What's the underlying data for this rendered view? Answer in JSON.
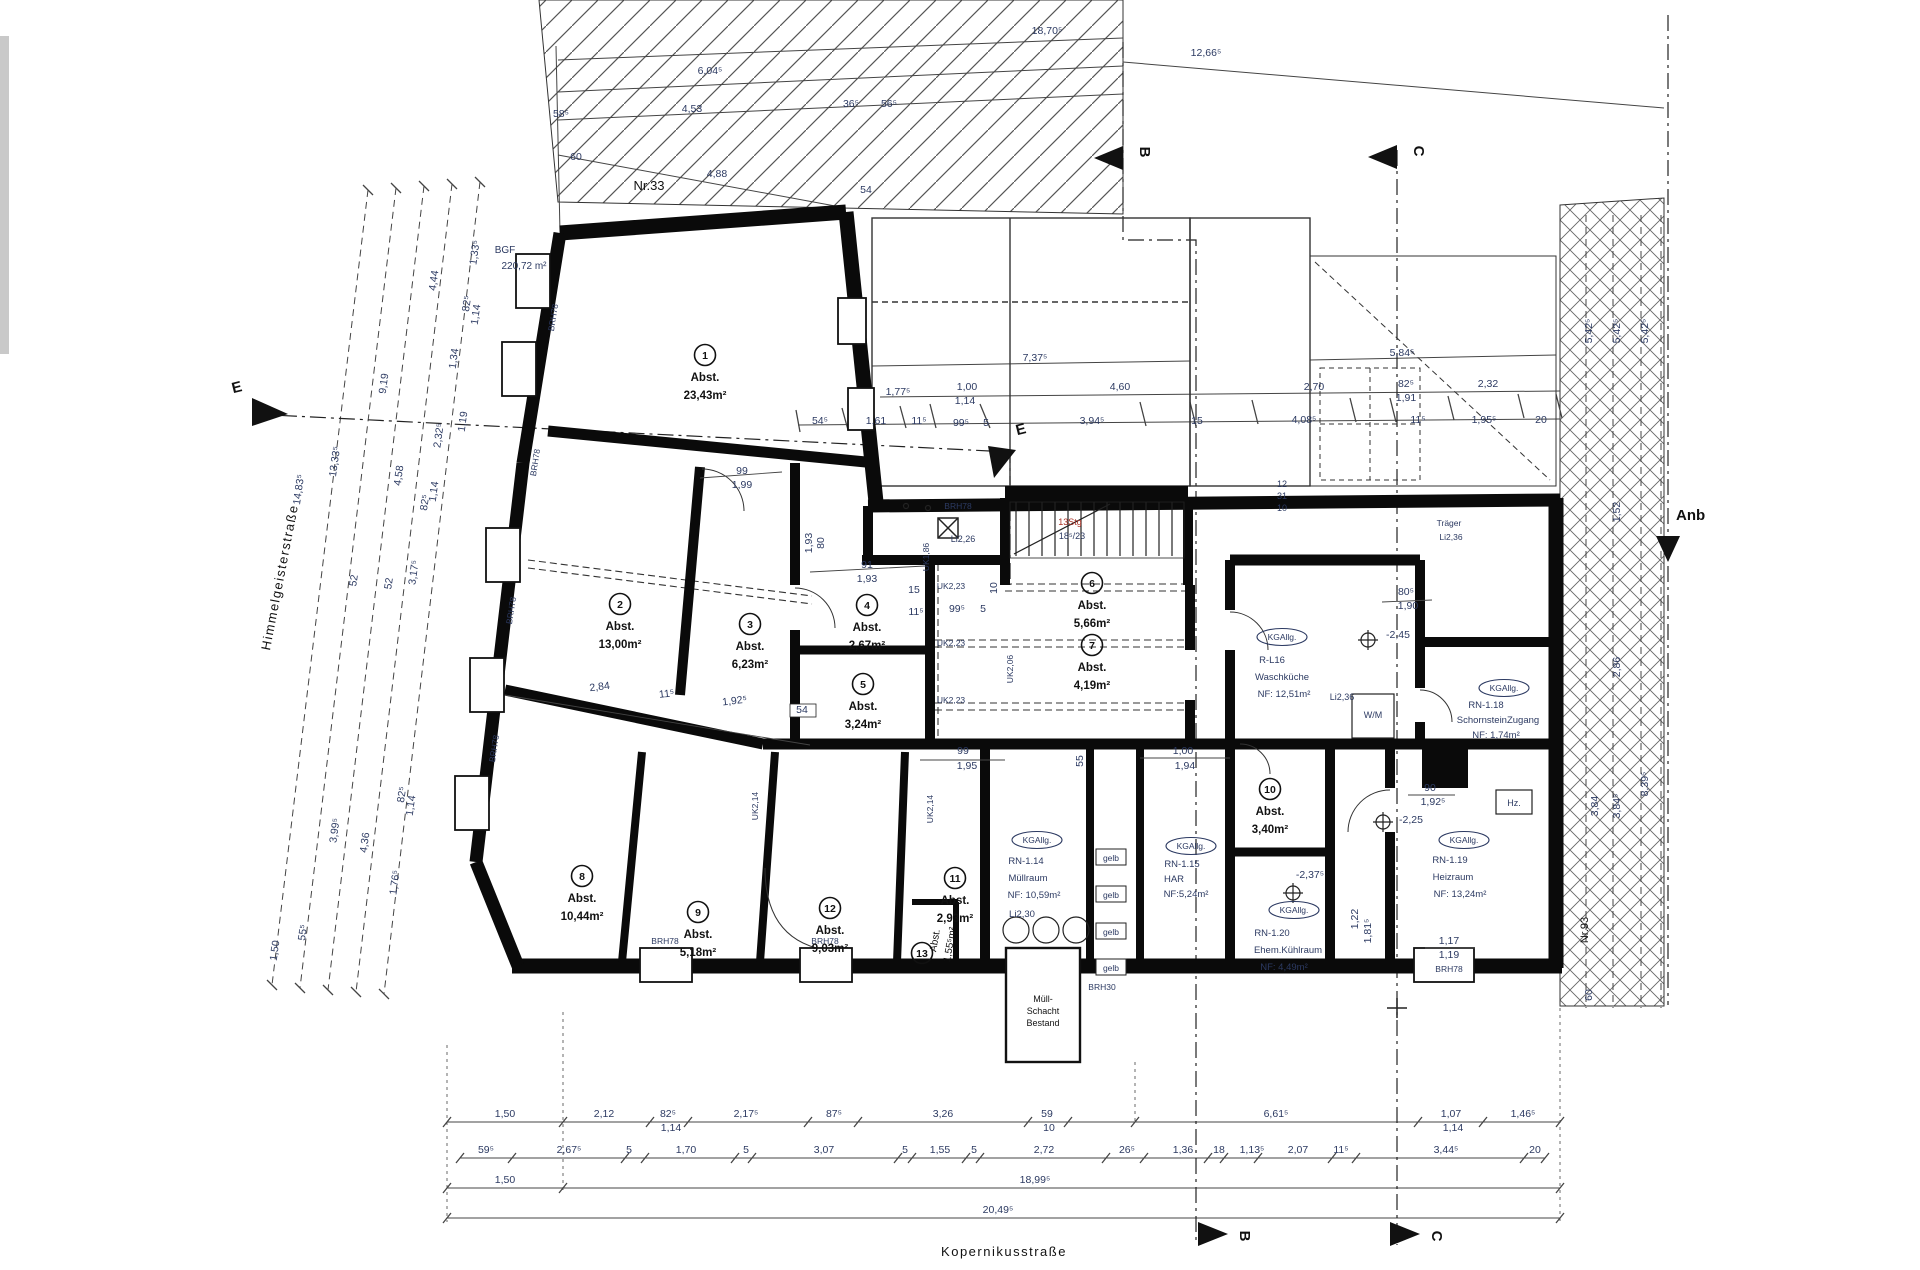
{
  "colors": {
    "dim": "#2c3a62",
    "note": "#2c3a62",
    "label": "#111111",
    "red": "#a93226",
    "wall": "#000000",
    "hatch": "#555555",
    "scrollbar": "#c9c9c9"
  },
  "streets": {
    "left": "Himmelgeisterstraße",
    "bottom": "Kopernikusstraße"
  },
  "site": {
    "neighbor_top": "Nr.33",
    "neighbor_right": "Nr.93",
    "annex_label": "Anb",
    "bgf_line1": "BGF",
    "bgf_line2": "220,72 m²"
  },
  "markers": [
    {
      "label": "B",
      "x": 1140,
      "y": 152,
      "rot": 90,
      "tri": "1123,146 1123,170 1094,158"
    },
    {
      "label": "C",
      "x": 1414,
      "y": 151,
      "rot": 90,
      "tri": "1397,145 1397,169 1368,157"
    },
    {
      "label": "E",
      "x": 238,
      "y": 392,
      "rot": -14,
      "tri": "252,398 252,426 288,414"
    },
    {
      "label": "E",
      "x": 1022,
      "y": 434,
      "rot": -14,
      "tri": "988,446 1016,450 994,478"
    },
    {
      "label": "B",
      "x": 1240,
      "y": 1236,
      "rot": 90,
      "tri": "1198,1222 1198,1246 1228,1234"
    },
    {
      "label": "C",
      "x": 1432,
      "y": 1236,
      "rot": 90,
      "tri": "1390,1222 1390,1246 1420,1234"
    }
  ],
  "annex_marker_tri": "1656,536 1680,536 1668,562",
  "rooms": [
    {
      "n": "1",
      "x": 705,
      "y": 355,
      "a1": "Abst.",
      "a2": "23,43m²"
    },
    {
      "n": "2",
      "x": 620,
      "y": 604,
      "a1": "Abst.",
      "a2": "13,00m²"
    },
    {
      "n": "3",
      "x": 750,
      "y": 624,
      "a1": "Abst.",
      "a2": "6,23m²"
    },
    {
      "n": "4",
      "x": 867,
      "y": 605,
      "a1": "Abst.",
      "a2": "2,67m²"
    },
    {
      "n": "5",
      "x": 863,
      "y": 684,
      "a1": "Abst.",
      "a2": "3,24m²"
    },
    {
      "n": "6",
      "x": 1092,
      "y": 583,
      "a1": "Abst.",
      "a2": "5,66m²"
    },
    {
      "n": "7",
      "x": 1092,
      "y": 645,
      "a1": "Abst.",
      "a2": "4,19m²"
    },
    {
      "n": "8",
      "x": 582,
      "y": 876,
      "a1": "Abst.",
      "a2": "10,44m²"
    },
    {
      "n": "9",
      "x": 698,
      "y": 912,
      "a1": "Abst.",
      "a2": "5,18m²"
    },
    {
      "n": "10",
      "x": 1270,
      "y": 789,
      "a1": "Abst.",
      "a2": "3,40m²"
    },
    {
      "n": "11",
      "x": 955,
      "y": 878,
      "a1": "Abst.",
      "a2": "2,93m²"
    },
    {
      "n": "12",
      "x": 830,
      "y": 908,
      "a1": "Abst.",
      "a2": "9,03m²"
    },
    {
      "n": "13",
      "x": 922,
      "y": 953,
      "a1": "",
      "a2": ""
    }
  ],
  "spaces": [
    {
      "oval": "KGAllg.",
      "ox": 1282,
      "oy": 637,
      "lines": [
        {
          "t": "R-L16",
          "x": 1272,
          "y": 663
        },
        {
          "t": "Waschküche",
          "x": 1282,
          "y": 680
        },
        {
          "t": "NF: 12,51m²",
          "x": 1284,
          "y": 697
        }
      ]
    },
    {
      "oval": "KGAllg.",
      "ox": 1504,
      "oy": 688,
      "lines": [
        {
          "t": "RN-1.18",
          "x": 1486,
          "y": 708
        },
        {
          "t": "SchornsteinZugang",
          "x": 1498,
          "y": 723
        },
        {
          "t": "NF: 1,74m²",
          "x": 1496,
          "y": 738
        }
      ]
    },
    {
      "oval": "KGAllg.",
      "ox": 1464,
      "oy": 840,
      "lines": [
        {
          "t": "RN-1.19",
          "x": 1450,
          "y": 863
        },
        {
          "t": "Heizraum",
          "x": 1453,
          "y": 880
        },
        {
          "t": "NF: 13,24m²",
          "x": 1460,
          "y": 897
        }
      ]
    },
    {
      "oval": "KGAllg.",
      "ox": 1294,
      "oy": 910,
      "lines": [
        {
          "t": "RN-1.20",
          "x": 1272,
          "y": 936
        },
        {
          "t": "Ehem.Kühlraum",
          "x": 1288,
          "y": 953
        },
        {
          "t": "NF: 4,49m²",
          "x": 1284,
          "y": 970
        }
      ]
    },
    {
      "oval": "KGAllg.",
      "ox": 1037,
      "oy": 840,
      "lines": [
        {
          "t": "RN-1.14",
          "x": 1026,
          "y": 864
        },
        {
          "t": "Müllraum",
          "x": 1028,
          "y": 881
        },
        {
          "t": "NF: 10,59m²",
          "x": 1034,
          "y": 898
        },
        {
          "t": "Li2,30",
          "x": 1022,
          "y": 917
        }
      ]
    },
    {
      "oval": "KGAllg.",
      "ox": 1191,
      "oy": 846,
      "lines": [
        {
          "t": "RN-1.15",
          "x": 1182,
          "y": 867
        },
        {
          "t": "HAR",
          "x": 1174,
          "y": 882
        },
        {
          "t": "NF:5,24m²",
          "x": 1186,
          "y": 897
        }
      ]
    }
  ],
  "notes": [
    {
      "t": "Nr.33",
      "x": 649,
      "y": 190,
      "s": 13,
      "c": "#111111"
    },
    {
      "t": "Nr.93",
      "x": 1588,
      "y": 930,
      "r": -90,
      "s": 11,
      "c": "#111111"
    },
    {
      "t": "BGF",
      "x": 505,
      "y": 253,
      "s": 10
    },
    {
      "t": "220,72 m²",
      "x": 524,
      "y": 269,
      "s": 10
    },
    {
      "t": "Träger",
      "x": 1449,
      "y": 526,
      "s": 8.5
    },
    {
      "t": "Li2,36",
      "x": 1451,
      "y": 540,
      "s": 8.5
    },
    {
      "t": "Li2,36",
      "x": 1342,
      "y": 700,
      "s": 9
    },
    {
      "t": "BRH78",
      "x": 958,
      "y": 509,
      "s": 8.5
    },
    {
      "t": "Li2,26",
      "x": 963,
      "y": 542,
      "s": 9
    },
    {
      "t": "UK2,23",
      "x": 951,
      "y": 589,
      "s": 8.5
    },
    {
      "t": "UK2,23",
      "x": 951,
      "y": 646,
      "s": 8.5
    },
    {
      "t": "UK2,23",
      "x": 951,
      "y": 703,
      "s": 8.5
    },
    {
      "t": "UK1,86",
      "x": 929,
      "y": 557,
      "r": -90,
      "s": 8.5
    },
    {
      "t": "UK2,06",
      "x": 1013,
      "y": 669,
      "r": -90,
      "s": 8.5
    },
    {
      "t": "UK2,14",
      "x": 758,
      "y": 806,
      "r": -90,
      "s": 8.5
    },
    {
      "t": "UK2,14",
      "x": 933,
      "y": 809,
      "r": -90,
      "s": 8.5
    },
    {
      "t": "BRH78",
      "x": 556,
      "y": 318,
      "r": -81,
      "s": 8.5
    },
    {
      "t": "BRH78",
      "x": 538,
      "y": 463,
      "r": -81,
      "s": 8.5
    },
    {
      "t": "BRH78",
      "x": 514,
      "y": 611,
      "r": -81,
      "s": 8.5
    },
    {
      "t": "BRH78",
      "x": 497,
      "y": 749,
      "r": -81,
      "s": 8.5
    },
    {
      "t": "BRH78",
      "x": 665,
      "y": 944,
      "s": 8.5
    },
    {
      "t": "BRH78",
      "x": 825,
      "y": 944,
      "s": 8.5
    },
    {
      "t": "BRH78",
      "x": 1449,
      "y": 972,
      "s": 8.5
    },
    {
      "t": "13Stg",
      "x": 1070,
      "y": 525,
      "s": 9,
      "c": "#a93226"
    },
    {
      "t": "18⁵/23",
      "x": 1072,
      "y": 539,
      "s": 9
    },
    {
      "t": "W/M",
      "x": 1373,
      "y": 718,
      "s": 9
    },
    {
      "t": "Hz.",
      "x": 1514,
      "y": 806,
      "s": 9
    },
    {
      "t": "gelb",
      "x": 1111,
      "y": 861,
      "s": 8.5
    },
    {
      "t": "gelb",
      "x": 1111,
      "y": 898,
      "s": 8.5
    },
    {
      "t": "gelb",
      "x": 1111,
      "y": 935,
      "s": 8.5
    },
    {
      "t": "gelb",
      "x": 1111,
      "y": 971,
      "s": 8.5
    },
    {
      "t": "BRH30",
      "x": 1102,
      "y": 990,
      "s": 8.5
    },
    {
      "t": "Müll-",
      "x": 1043,
      "y": 1002,
      "s": 9,
      "c": "#111111"
    },
    {
      "t": "Schacht",
      "x": 1043,
      "y": 1014,
      "s": 9,
      "c": "#111111"
    },
    {
      "t": "Bestand",
      "x": 1043,
      "y": 1026,
      "s": 9,
      "c": "#111111"
    },
    {
      "t": "Abst.",
      "x": 938,
      "y": 941,
      "r": -80,
      "s": 10,
      "c": "#111111"
    },
    {
      "t": "1,55⁵m²",
      "x": 953,
      "y": 945,
      "r": -80,
      "s": 10,
      "c": "#111111"
    }
  ],
  "dims": [
    {
      "t": "18,70⁵",
      "x": 1047,
      "y": 34
    },
    {
      "t": "12,66⁵",
      "x": 1206,
      "y": 56
    },
    {
      "t": "6,04⁵",
      "x": 710,
      "y": 74
    },
    {
      "t": "4,53",
      "x": 692,
      "y": 112
    },
    {
      "t": "58⁵",
      "x": 561,
      "y": 117
    },
    {
      "t": "36⁵",
      "x": 851,
      "y": 107
    },
    {
      "t": "56⁵",
      "x": 889,
      "y": 107
    },
    {
      "t": "60",
      "x": 576,
      "y": 160
    },
    {
      "t": "4,88",
      "x": 717,
      "y": 177
    },
    {
      "t": "54",
      "x": 866,
      "y": 193
    },
    {
      "t": "7,37⁵",
      "x": 1035,
      "y": 361
    },
    {
      "t": "5,84⁵",
      "x": 1402,
      "y": 356
    },
    {
      "t": "1,77⁵",
      "x": 898,
      "y": 395
    },
    {
      "t": "1,00",
      "x": 967,
      "y": 390
    },
    {
      "t": "1,14",
      "x": 965,
      "y": 404
    },
    {
      "t": "4,60",
      "x": 1120,
      "y": 390
    },
    {
      "t": "2,70",
      "x": 1314,
      "y": 390
    },
    {
      "t": "82⁵",
      "x": 1406,
      "y": 387
    },
    {
      "t": "1,91",
      "x": 1406,
      "y": 401
    },
    {
      "t": "2,32",
      "x": 1488,
      "y": 387
    },
    {
      "t": "54⁵",
      "x": 820,
      "y": 424
    },
    {
      "t": "1,61",
      "x": 876,
      "y": 424
    },
    {
      "t": "11⁵",
      "x": 919,
      "y": 424
    },
    {
      "t": "99⁵",
      "x": 961,
      "y": 426
    },
    {
      "t": "5",
      "x": 986,
      "y": 426
    },
    {
      "t": "3,94⁵",
      "x": 1092,
      "y": 424
    },
    {
      "t": "15",
      "x": 1197,
      "y": 424
    },
    {
      "t": "4,08⁵",
      "x": 1304,
      "y": 423
    },
    {
      "t": "11⁵",
      "x": 1418,
      "y": 423
    },
    {
      "t": "1,95⁵",
      "x": 1484,
      "y": 423
    },
    {
      "t": "20",
      "x": 1541,
      "y": 423
    },
    {
      "t": "12",
      "x": 1282,
      "y": 487,
      "s": 9
    },
    {
      "t": "31",
      "x": 1282,
      "y": 499,
      "s": 9
    },
    {
      "t": "10",
      "x": 1282,
      "y": 511,
      "s": 9
    },
    {
      "t": "14,83⁵",
      "x": 302,
      "y": 490,
      "r": -82
    },
    {
      "t": "13,33⁵",
      "x": 338,
      "y": 462,
      "r": -82
    },
    {
      "t": "9,19",
      "x": 387,
      "y": 384,
      "r": -82
    },
    {
      "t": "4,58",
      "x": 402,
      "y": 476,
      "r": -82
    },
    {
      "t": "4,44",
      "x": 437,
      "y": 281,
      "r": -82
    },
    {
      "t": "2,32⁵",
      "x": 442,
      "y": 436,
      "r": -82
    },
    {
      "t": "1,14",
      "x": 437,
      "y": 492,
      "r": -82
    },
    {
      "t": "82⁵",
      "x": 428,
      "y": 503,
      "r": -82
    },
    {
      "t": "1,33⁵",
      "x": 478,
      "y": 253,
      "r": -82
    },
    {
      "t": "82⁵",
      "x": 470,
      "y": 304,
      "r": -82
    },
    {
      "t": "1,14",
      "x": 479,
      "y": 315,
      "r": -82
    },
    {
      "t": "1,34",
      "x": 457,
      "y": 359,
      "r": -82
    },
    {
      "t": "1,19",
      "x": 466,
      "y": 422,
      "r": -82
    },
    {
      "t": "52",
      "x": 357,
      "y": 581,
      "r": -82
    },
    {
      "t": "52",
      "x": 392,
      "y": 584,
      "r": -82
    },
    {
      "t": "3,17⁵",
      "x": 417,
      "y": 573,
      "r": -82
    },
    {
      "t": "82⁵",
      "x": 405,
      "y": 795,
      "r": -82
    },
    {
      "t": "1,14",
      "x": 414,
      "y": 806,
      "r": -82
    },
    {
      "t": "3,99⁵",
      "x": 338,
      "y": 831,
      "r": -82
    },
    {
      "t": "4,36",
      "x": 368,
      "y": 843,
      "r": -82
    },
    {
      "t": "1,76⁵",
      "x": 398,
      "y": 883,
      "r": -82
    },
    {
      "t": "55⁵",
      "x": 306,
      "y": 933,
      "r": -82
    },
    {
      "t": "1,50",
      "x": 278,
      "y": 951,
      "r": -82
    },
    {
      "t": "5,42⁵",
      "x": 1592,
      "y": 331,
      "r": -90
    },
    {
      "t": "5,42⁵",
      "x": 1620,
      "y": 331,
      "r": -90
    },
    {
      "t": "5,42⁵",
      "x": 1648,
      "y": 331,
      "r": -90
    },
    {
      "t": "1,52",
      "x": 1620,
      "y": 512,
      "r": -90
    },
    {
      "t": "2,86",
      "x": 1620,
      "y": 667,
      "r": -90
    },
    {
      "t": "3,84",
      "x": 1598,
      "y": 806,
      "r": -90
    },
    {
      "t": "3,84⁵",
      "x": 1620,
      "y": 806,
      "r": -90
    },
    {
      "t": "8,39⁵",
      "x": 1648,
      "y": 784,
      "r": -90
    },
    {
      "t": "60",
      "x": 1592,
      "y": 995,
      "r": -90
    },
    {
      "t": "99",
      "x": 742,
      "y": 474
    },
    {
      "t": "1,99",
      "x": 742,
      "y": 488
    },
    {
      "t": "80",
      "x": 824,
      "y": 543,
      "r": -90
    },
    {
      "t": "1,93",
      "x": 812,
      "y": 543,
      "r": -90
    },
    {
      "t": "91",
      "x": 867,
      "y": 568
    },
    {
      "t": "1,93",
      "x": 867,
      "y": 582
    },
    {
      "t": "15",
      "x": 914,
      "y": 593
    },
    {
      "t": "11⁵",
      "x": 916,
      "y": 615
    },
    {
      "t": "99⁵",
      "x": 957,
      "y": 612
    },
    {
      "t": "5",
      "x": 983,
      "y": 612
    },
    {
      "t": "10",
      "x": 997,
      "y": 588,
      "r": -90
    },
    {
      "t": "2,84",
      "x": 600,
      "y": 690,
      "r": -7
    },
    {
      "t": "11⁵",
      "x": 667,
      "y": 697,
      "r": -7
    },
    {
      "t": "1,92⁵",
      "x": 735,
      "y": 704,
      "r": -7
    },
    {
      "t": "54",
      "x": 802,
      "y": 713
    },
    {
      "t": "99",
      "x": 963,
      "y": 754
    },
    {
      "t": "1,95",
      "x": 967,
      "y": 769
    },
    {
      "t": "55",
      "x": 1083,
      "y": 761,
      "r": -90
    },
    {
      "t": "1,00",
      "x": 1183,
      "y": 754
    },
    {
      "t": "1,94",
      "x": 1185,
      "y": 769
    },
    {
      "t": "80⁵",
      "x": 1406,
      "y": 595
    },
    {
      "t": "1,90",
      "x": 1408,
      "y": 609
    },
    {
      "t": "-2,45",
      "x": 1398,
      "y": 638
    },
    {
      "t": "90",
      "x": 1430,
      "y": 791
    },
    {
      "t": "1,92⁵",
      "x": 1433,
      "y": 805
    },
    {
      "t": "-2,25",
      "x": 1411,
      "y": 823
    },
    {
      "t": "-2,37⁵",
      "x": 1310,
      "y": 878
    },
    {
      "t": "1,17",
      "x": 1449,
      "y": 944
    },
    {
      "t": "1,19",
      "x": 1449,
      "y": 958
    },
    {
      "t": "1,22",
      "x": 1358,
      "y": 919,
      "r": -90
    },
    {
      "t": "1,81⁵",
      "x": 1371,
      "y": 931,
      "r": -90
    },
    {
      "t": "1,50",
      "x": 505,
      "y": 1117
    },
    {
      "t": "2,12",
      "x": 604,
      "y": 1117
    },
    {
      "t": "82⁵",
      "x": 668,
      "y": 1117
    },
    {
      "t": "1,14",
      "x": 671,
      "y": 1131
    },
    {
      "t": "2,17⁵",
      "x": 746,
      "y": 1117
    },
    {
      "t": "87⁵",
      "x": 834,
      "y": 1117
    },
    {
      "t": "3,26",
      "x": 943,
      "y": 1117
    },
    {
      "t": "59",
      "x": 1047,
      "y": 1117
    },
    {
      "t": "10",
      "x": 1049,
      "y": 1131
    },
    {
      "t": "6,61⁵",
      "x": 1276,
      "y": 1117
    },
    {
      "t": "1,07",
      "x": 1451,
      "y": 1117
    },
    {
      "t": "1,14",
      "x": 1453,
      "y": 1131
    },
    {
      "t": "1,46⁵",
      "x": 1523,
      "y": 1117
    },
    {
      "t": "59⁵",
      "x": 486,
      "y": 1153
    },
    {
      "t": "2,67⁵",
      "x": 569,
      "y": 1153
    },
    {
      "t": "5",
      "x": 629,
      "y": 1153
    },
    {
      "t": "1,70",
      "x": 686,
      "y": 1153
    },
    {
      "t": "5",
      "x": 746,
      "y": 1153
    },
    {
      "t": "3,07",
      "x": 824,
      "y": 1153
    },
    {
      "t": "5",
      "x": 905,
      "y": 1153
    },
    {
      "t": "1,55",
      "x": 940,
      "y": 1153
    },
    {
      "t": "5",
      "x": 974,
      "y": 1153
    },
    {
      "t": "2,72",
      "x": 1044,
      "y": 1153
    },
    {
      "t": "26⁵",
      "x": 1127,
      "y": 1153
    },
    {
      "t": "1,36",
      "x": 1183,
      "y": 1153
    },
    {
      "t": "18",
      "x": 1219,
      "y": 1153
    },
    {
      "t": "1,13⁵",
      "x": 1252,
      "y": 1153
    },
    {
      "t": "2,07",
      "x": 1298,
      "y": 1153
    },
    {
      "t": "11⁵",
      "x": 1341,
      "y": 1153
    },
    {
      "t": "3,44⁵",
      "x": 1446,
      "y": 1153
    },
    {
      "t": "20",
      "x": 1535,
      "y": 1153
    },
    {
      "t": "1,50",
      "x": 505,
      "y": 1183
    },
    {
      "t": "18,99⁵",
      "x": 1035,
      "y": 1183
    },
    {
      "t": "20,49⁵",
      "x": 998,
      "y": 1213
    }
  ]
}
